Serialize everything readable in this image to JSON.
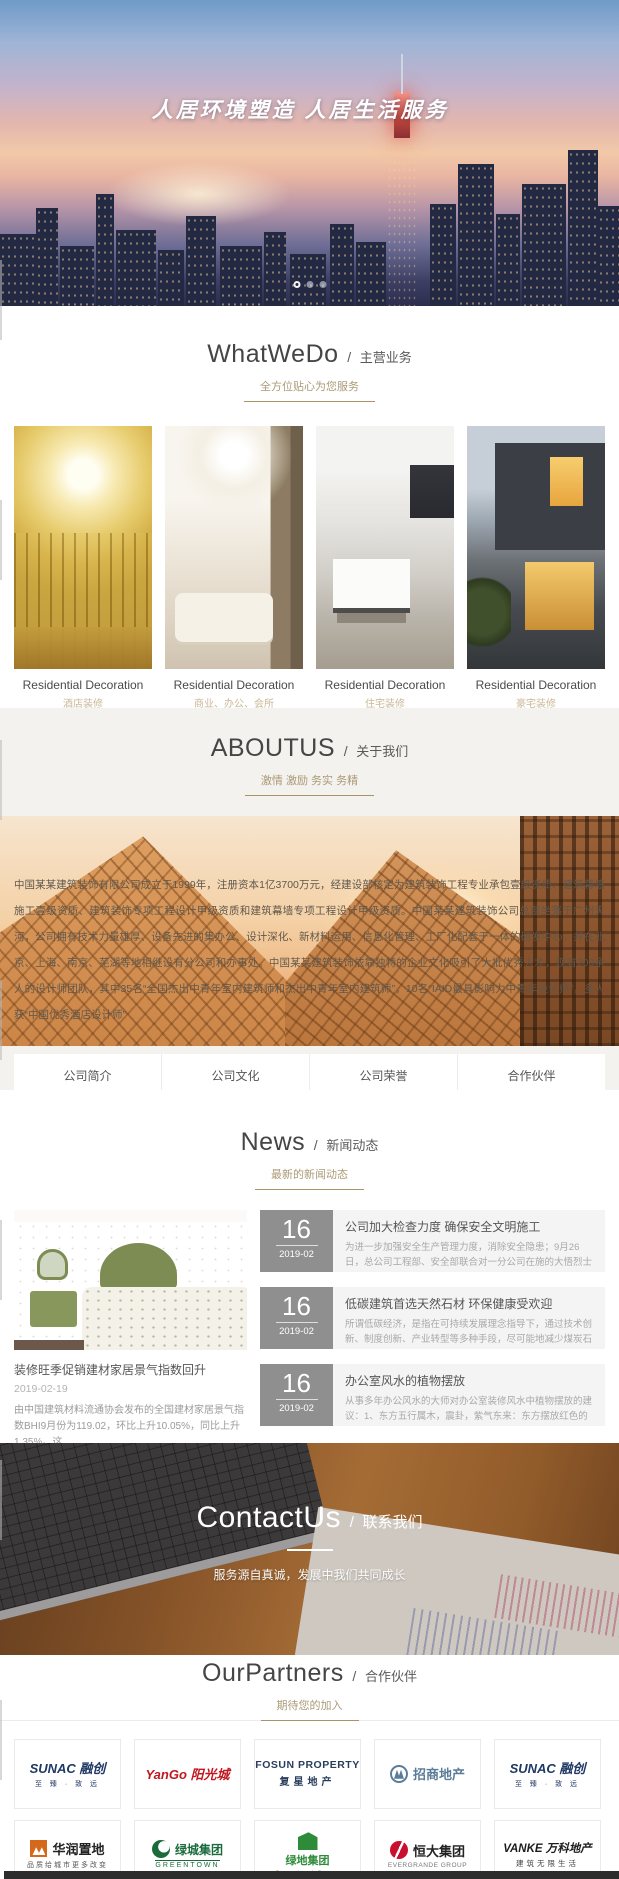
{
  "hero": {
    "slogan": "人居环境塑造 人居生活服务"
  },
  "sections": {
    "what_we_do": {
      "title_en": "WhatWeDo",
      "title_sep": "/",
      "title_cn": "主营业务",
      "subtitle": "全方位贴心为您服务",
      "cards": [
        {
          "title": "Residential Decoration",
          "subtitle": "酒店装修"
        },
        {
          "title": "Residential Decoration",
          "subtitle": "商业、办公、会所"
        },
        {
          "title": "Residential Decoration",
          "subtitle": "住宅装修"
        },
        {
          "title": "Residential Decoration",
          "subtitle": "豪宅装修"
        }
      ]
    },
    "about": {
      "title_en": "ABOUTUS",
      "title_sep": "/",
      "title_cn": "关于我们",
      "subtitle": "激情 激励 务实 务精",
      "paragraph": "中国某某建筑装饰有限公司成立于1999年，注册资本1亿3700万元，经建设部核定为建筑装饰工程专业承包壹级资质、建筑幕墙施工壹级资质、建筑装饰专项工程设计甲级资质和建筑幕墙专项工程设计甲级资质。中国某某建筑装饰公司总部坐落于广州天河，公司拥有技术力量雄厚、设备先进的集办公、设计深化、新材料运用、信息化管理、工厂化配套于一体的研发中心，并在北京、上海、南京、芜湖等地相继设有分公司和办事处。中国某某建筑装饰依靠独特的企业文化吸引了大批优秀人才，现有200余人的设计师团队，其中35名“全国杰出中青年室内建筑师和杰出中青年室内建筑师”，10名“IAID最具影响力中青年设计师”，多人获“中国优秀酒店设计师”",
      "tabs": [
        "公司简介",
        "公司文化",
        "公司荣誉",
        "合作伙伴"
      ]
    },
    "news": {
      "title_en": "News",
      "title_sep": "/",
      "title_cn": "新闻动态",
      "subtitle": "最新的新闻动态",
      "featured": {
        "title": "装修旺季促销建材家居景气指数回升",
        "date": "2019-02-19",
        "excerpt": "由中国建筑材料流通协会发布的全国建材家居景气指数BHI9月份为119.02，环比上升10.05%，同比上升1.35%。这",
        "more_label": "了解更多"
      },
      "items": [
        {
          "day": "16",
          "month": "2019-02",
          "title": "公司加大检查力度 确保安全文明施工",
          "excerpt": "为进一步加强安全生产管理力度，消除安全隐患；9月26日，总公司工程部、安全部联合对一分公司在施的大悟烈士纪念堂文物修缮项目"
        },
        {
          "day": "16",
          "month": "2019-02",
          "title": "低碳建筑首选天然石材 环保健康受欢迎",
          "excerpt": "所谓低碳经济，是指在可持续发展理念指导下，通过技术创新、制度创新、产业转型等多种手段，尽可能地减少煤炭石油等高碳能源消耗"
        },
        {
          "day": "16",
          "month": "2019-02",
          "title": "办公室风水的植物摆放",
          "excerpt": "从事多年办公风水的大师对办公室装修风水中植物摆放的建议：1、东方五行属木，震卦，紫气东来：东方摆放红色的花对文案策划、编"
        }
      ]
    },
    "contact": {
      "title_en": "ContactUs",
      "title_sep": "/",
      "title_cn": "联系我们",
      "subtitle": "服务源自真诚，发展中我们共同成长"
    },
    "partners": {
      "title_en": "OurPartners",
      "title_sep": "/",
      "title_cn": "合作伙伴",
      "subtitle": "期待您的加入",
      "logos": [
        {
          "name": "sunac",
          "main": "SUNAC 融创",
          "sub": "至 臻 · 致 远",
          "color": "#1f3864"
        },
        {
          "name": "yango",
          "main": "YanGo 阳光城",
          "sub": "",
          "color": "#c01820"
        },
        {
          "name": "fosun",
          "main": "FOSUN PROPERTY",
          "sub": "复星地产",
          "color": "#2a3e5c"
        },
        {
          "name": "cmp",
          "main": "招商地产",
          "sub": "",
          "color": "#5b7c99"
        },
        {
          "name": "sunac2",
          "main": "SUNAC 融创",
          "sub": "至 臻 · 致 远",
          "color": "#1f3864"
        },
        {
          "name": "crland",
          "main": "华润置地",
          "sub": "品质给城市更多改变",
          "color": "#d4691e"
        },
        {
          "name": "greentown",
          "main": "绿城集团",
          "sub": "GREENTOWN",
          "color": "#1a6b3c"
        },
        {
          "name": "greenland",
          "main": "绿地集团",
          "sub": "Greenland Group",
          "color": "#2e8b3a"
        },
        {
          "name": "evergrande",
          "main": "恒大集团",
          "sub": "EVERGRANDE GROUP",
          "color": "#c8102e"
        },
        {
          "name": "vanke",
          "main": "VANKE 万科地产",
          "sub": "建筑无限生活",
          "color": "#1d1d1d"
        }
      ]
    }
  }
}
